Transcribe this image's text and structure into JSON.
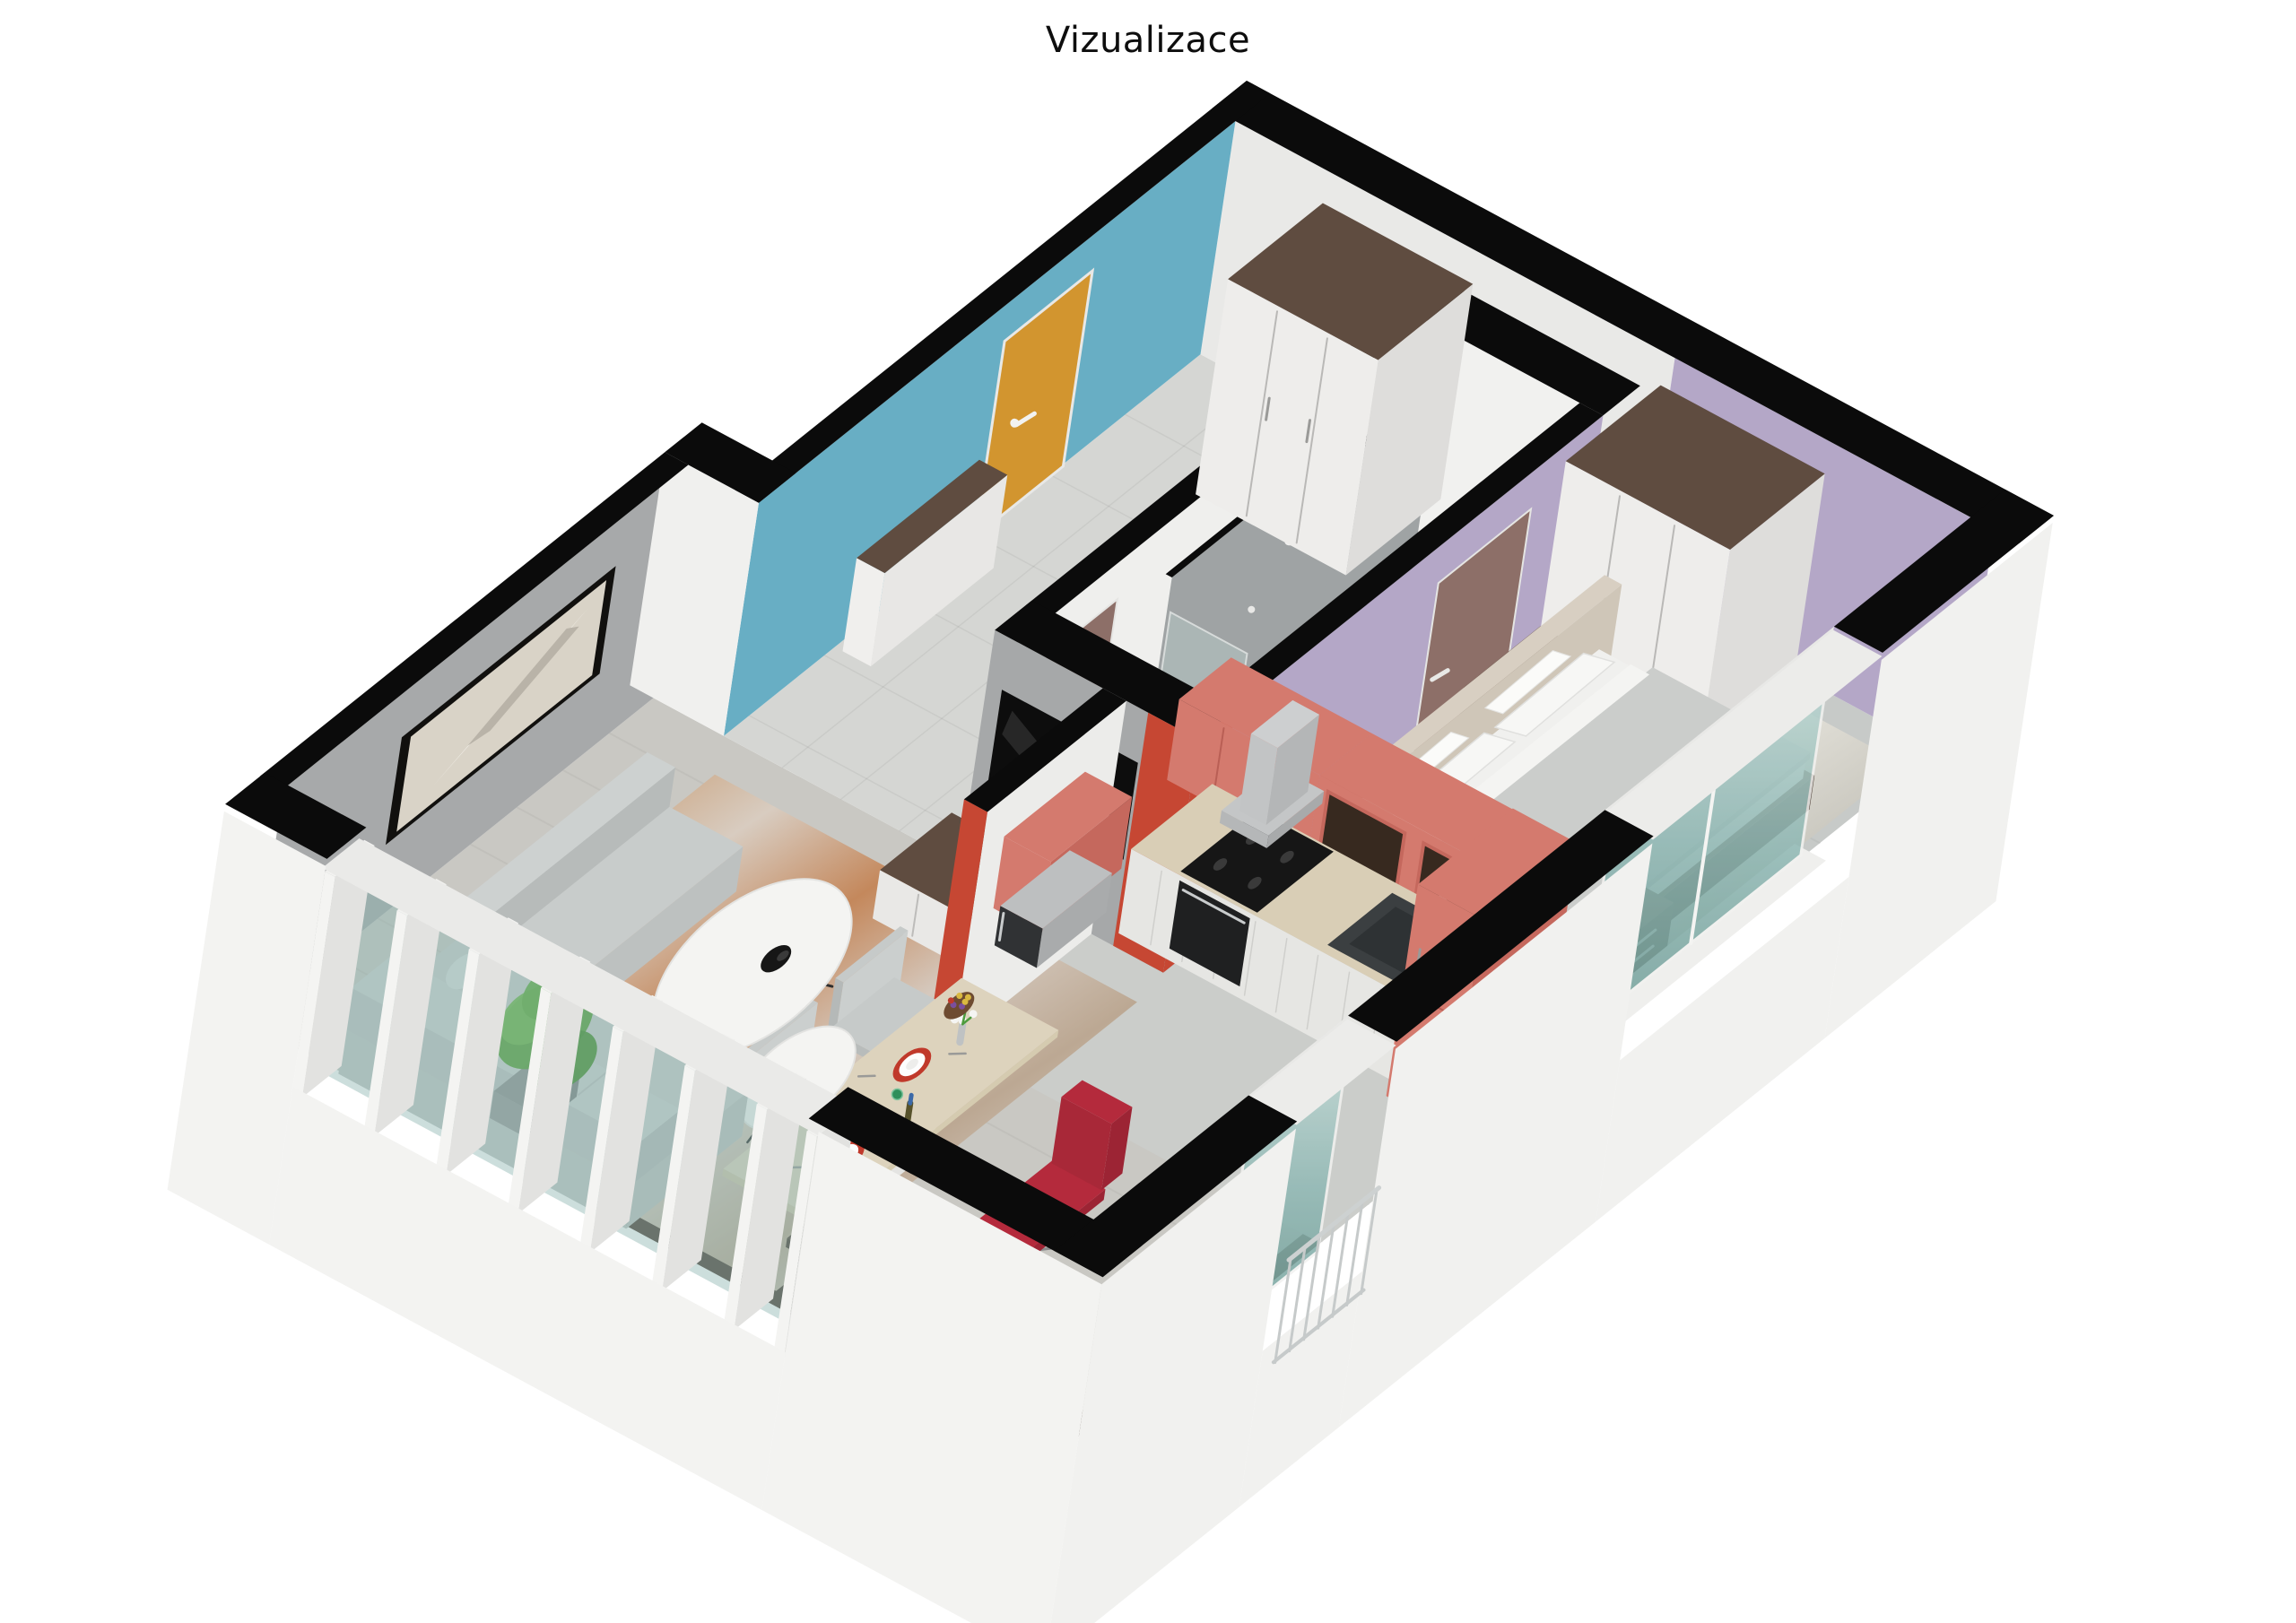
{
  "title": "Vizualizace",
  "palette": {
    "wallTop": "#0b0b0b",
    "exterior": "#F1F1EF",
    "blue": "#68AEC4",
    "orange": "#D2952F",
    "lavender": "#B4A7C7",
    "coral": "#D47A6E",
    "coralDark": "#C5685D",
    "redAccent": "#C64733",
    "mauve": "#8D6F68",
    "grayWall": "#A7A9AA",
    "tileGray": "#9FA3A4",
    "tileWhite": "#F1F1EF",
    "woodDark": "#5F4C40",
    "counterWood": "#D9CEB6",
    "cabinetWhite": "#E6E6E3",
    "sinkDark": "#3B3F41",
    "floorHall": "#D5D6D3",
    "floorBath": "#EDEDEB",
    "showerFloor": "#B9BDBE",
    "floorBed": "#C7CAC8",
    "floorKitchen": "#CBCDCA",
    "floorLiving": "#C9C8C3",
    "sofa": "#C8CCCB",
    "redChair": "#B42A3C",
    "plateRed": "#C0392B",
    "headboard": "#D8CFC2",
    "glassTeal": "#8FB8B4",
    "steel": "#BDBFC0",
    "plantGreen": "#4F9C31",
    "marbleWhite": "#F4F4F2"
  },
  "scene": {
    "type": "3d-floorplan",
    "rooms": [
      {
        "name": "living-room",
        "items": [
          "sofa",
          "coffee-table-large",
          "coffee-table-small",
          "area-rug",
          "tv-screen",
          "tv-sideboard",
          "desk",
          "monitor",
          "keyboard",
          "office-chair",
          "plant",
          "wall-painting",
          "window-wall"
        ]
      },
      {
        "name": "kitchen",
        "items": [
          "upper-cabinets",
          "glass-cabinets",
          "base-cabinets",
          "counter",
          "sink",
          "range-hood",
          "stove",
          "oven",
          "microwave",
          "tall-cabinet",
          "dining-table",
          "dining-chairs",
          "plates",
          "wine-bottle",
          "flower-vase",
          "fruit-bowl"
        ]
      },
      {
        "name": "bedroom",
        "items": [
          "double-bed",
          "pillows",
          "headboard",
          "nightstands",
          "wardrobe",
          "marble-rug",
          "window"
        ]
      },
      {
        "name": "bathroom",
        "items": [
          "shower",
          "shower-glass",
          "washing-machine",
          "toilet",
          "doors"
        ]
      },
      {
        "name": "hallway",
        "items": [
          "entrance-door",
          "wardrobe",
          "shoe-cabinet"
        ]
      }
    ]
  }
}
